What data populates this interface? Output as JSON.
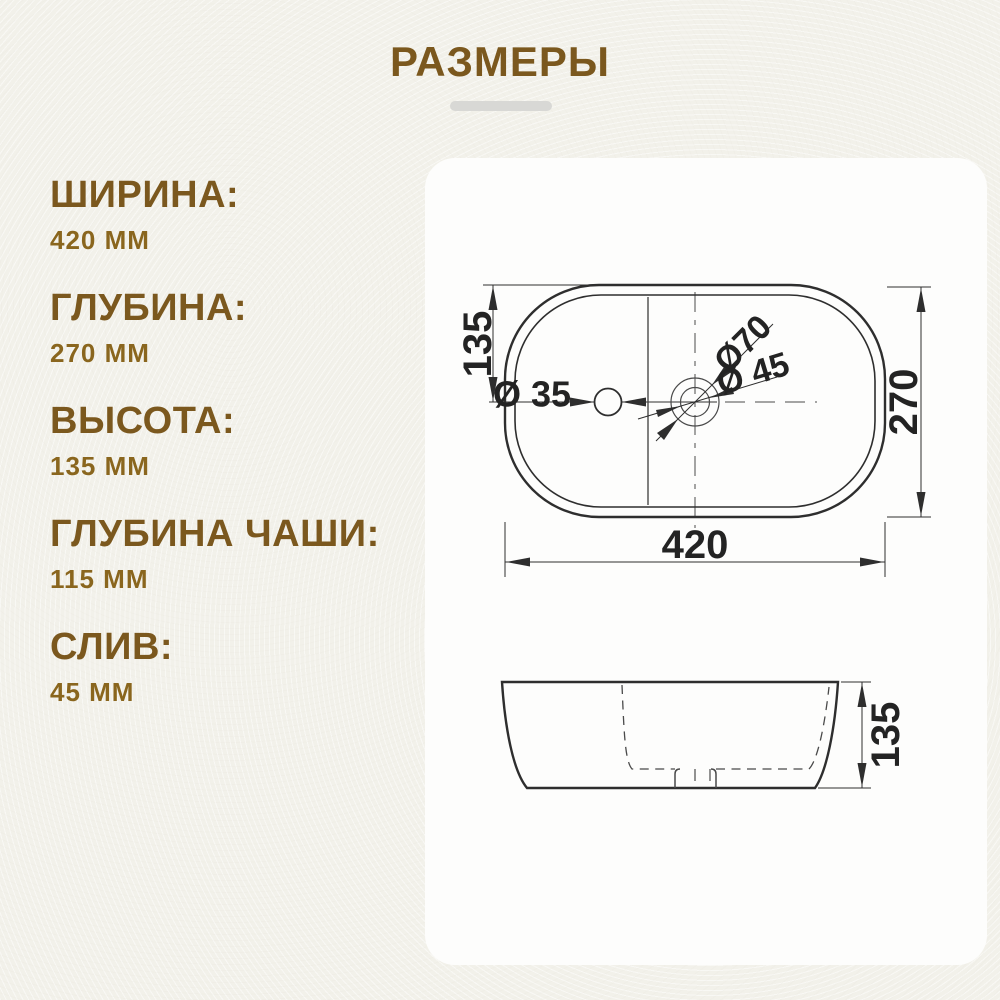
{
  "title": "РАЗМЕРЫ",
  "specs": [
    {
      "label": "ШИРИНА:",
      "value": "420 ММ"
    },
    {
      "label": "ГЛУБИНА:",
      "value": "270 ММ"
    },
    {
      "label": "ВЫСОТА:",
      "value": "135 ММ"
    },
    {
      "label": "ГЛУБИНА ЧАШИ:",
      "value": "115 ММ"
    },
    {
      "label": "СЛИВ:",
      "value": "45 ММ"
    }
  ],
  "drawing": {
    "top_view": {
      "width": "420",
      "height": "270",
      "half_depth": "135",
      "faucet_hole": "Ø 35",
      "drain_outer": "Ø70",
      "drain_inner": "Ø 45"
    },
    "side_view": {
      "height": "135"
    }
  },
  "colors": {
    "background": "#f2f1ea",
    "card": "#fdfdfc",
    "accent_heading": "#7b581e",
    "accent_value": "#8a661e",
    "line": "#2e2e2e",
    "divider": "#d8d8d5"
  }
}
